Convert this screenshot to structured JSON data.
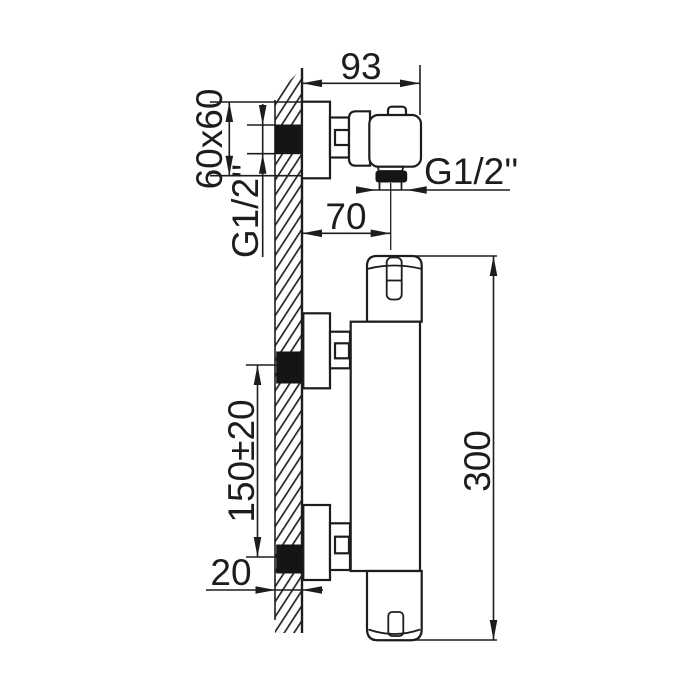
{
  "page": {
    "background": "#ffffff",
    "line_color": "#1d1d1d",
    "drawing_type": "thermostatic shower mixer installation dimensions"
  },
  "top_view": {
    "width_mm": "93",
    "wall_plate": "60x60",
    "inlet_thread": "G1/2''",
    "outlet_offset_mm": "70",
    "outlet_thread": "G1/2''"
  },
  "front_view": {
    "inlet_spacing_mm": "150±20",
    "wall_depth_mm": "20",
    "body_height_mm": "300"
  }
}
